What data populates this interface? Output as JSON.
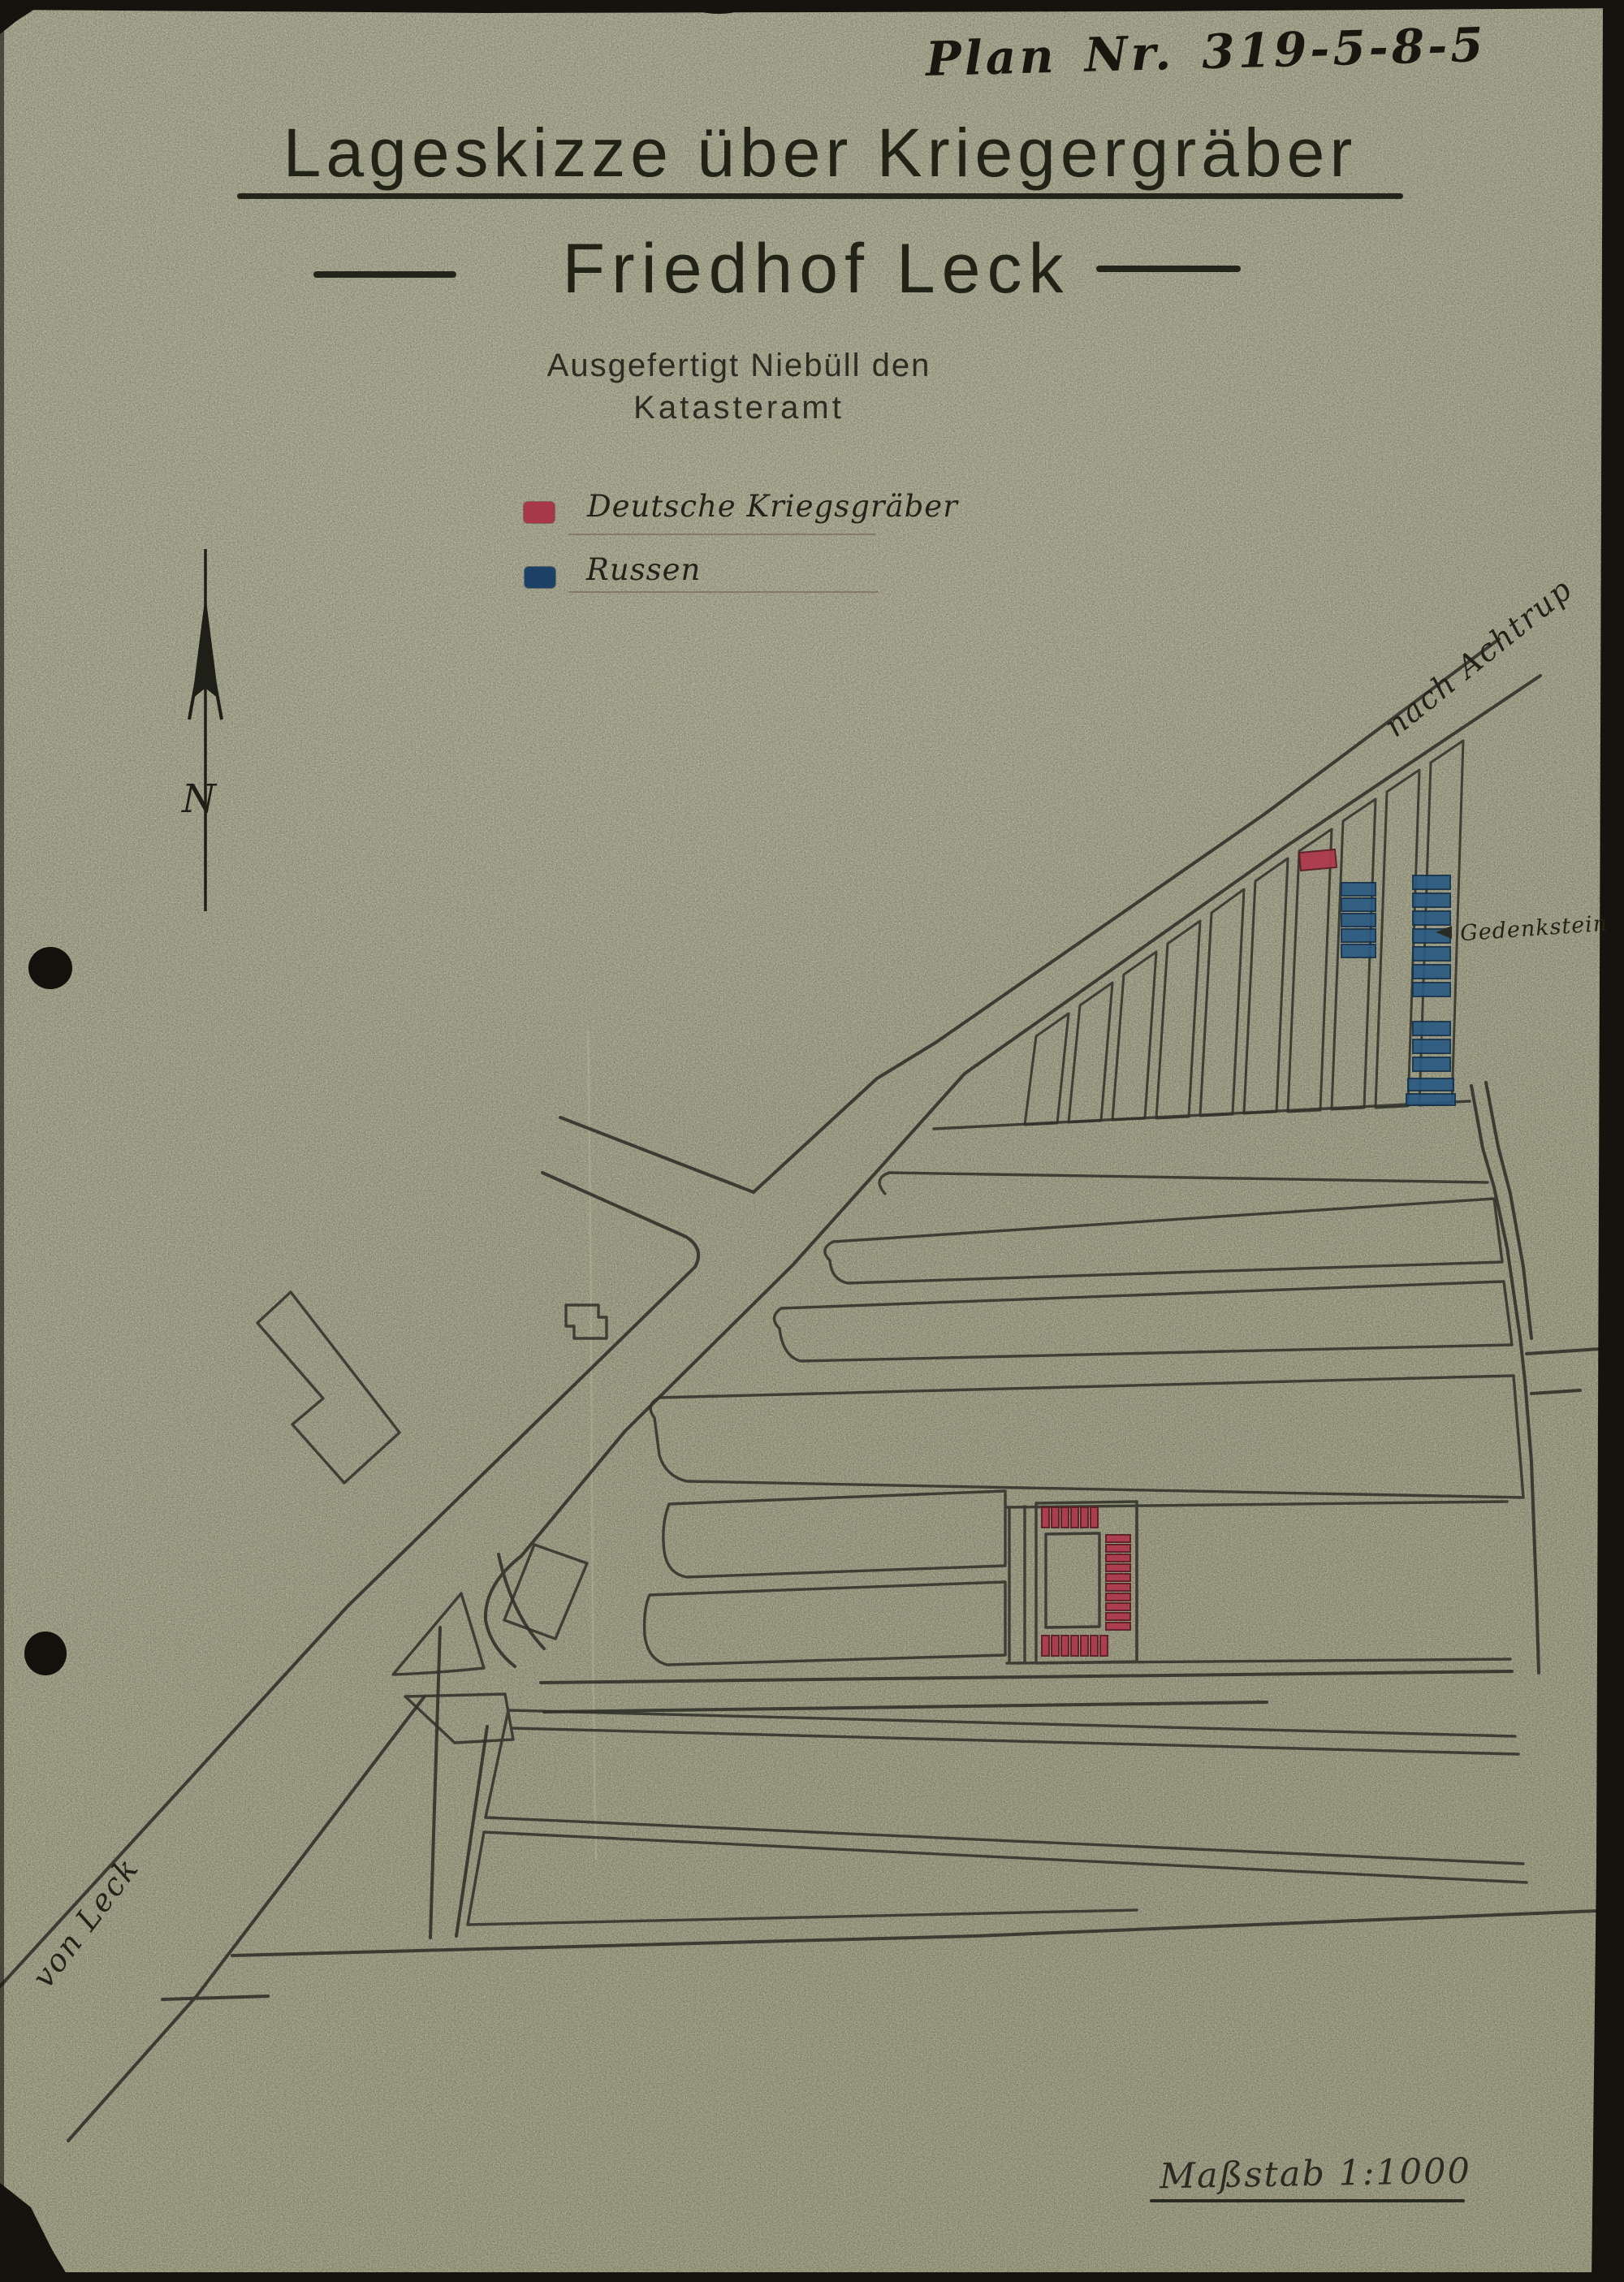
{
  "page": {
    "plan_number": "Plan Nr. 319-5-8-5",
    "title": "Lageskizze über Kriegergräber",
    "subtitle": "Friedhof Leck",
    "issued_line_1": "Ausgefertigt Niebüll den",
    "issued_line_2": "Katasteramt",
    "scale_label": "Maßstab 1:1000"
  },
  "legend": {
    "items": [
      {
        "label": "Deutsche Kriegsgräber",
        "color": "#a8374a"
      },
      {
        "label": "Russen",
        "color": "#1d4066"
      }
    ]
  },
  "map": {
    "labels": {
      "north": "N",
      "road_to": "nach Achtrup",
      "road_from": "von Leck",
      "memorial": "Gedenkstein"
    },
    "colors": {
      "german_graves": "#a8374a",
      "russian_graves": "#2a5a82",
      "ink": "#31322a",
      "paper": "#a2a28d"
    }
  }
}
